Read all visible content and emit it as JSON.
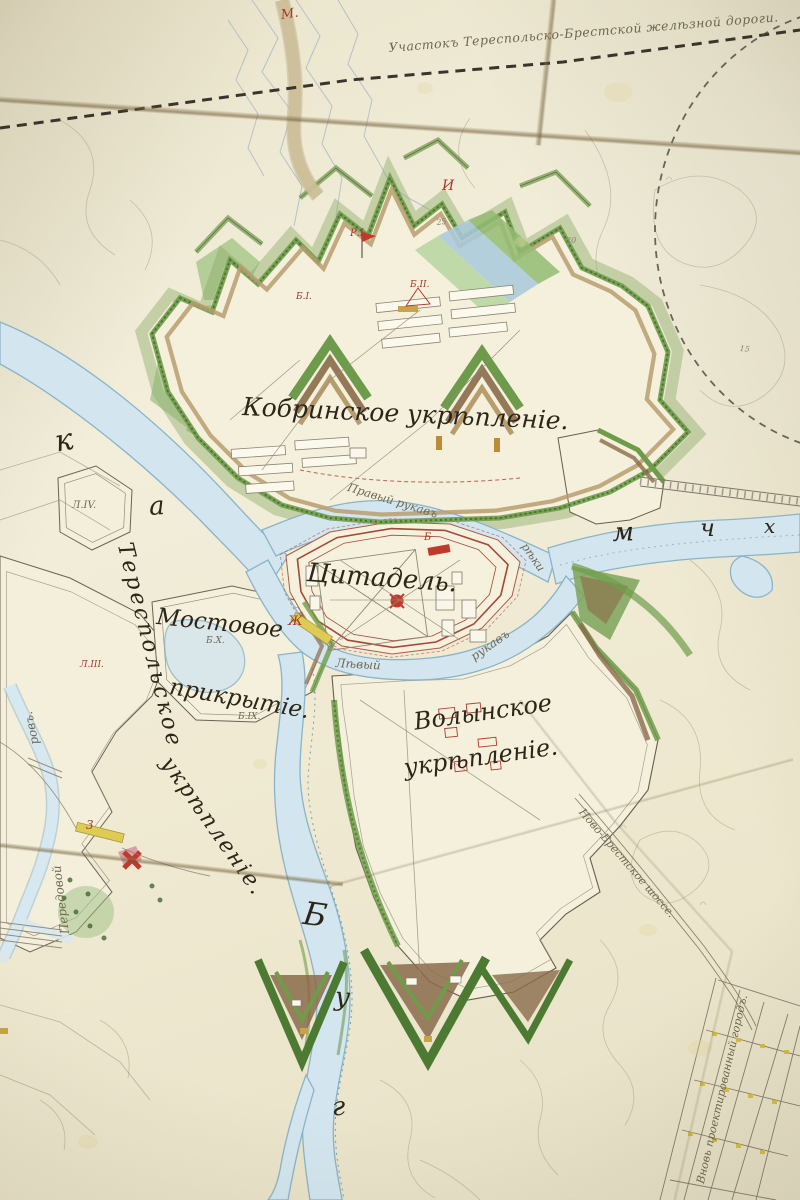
{
  "labels": {
    "railway_note": "Участокъ Тереспольско-Брестской желѣзной дороги.",
    "kobrin": "Кобринское укрѣпленіе.",
    "citadel": "Цитадель.",
    "volyn_line1": "Волынское",
    "volyn_line2": "укрѣпленіе.",
    "terespol_line1": "Тереспольское",
    "terespol_line2": "укрѣпленіе.",
    "mostovoe_line1": "Мостовое",
    "mostovoe_line2": "прикрытіе.",
    "pravy_rukav": "Правый рукавъ",
    "pravy_rukav_reki": "рѣки",
    "levy_rukav_1": "Лѣвый",
    "levy_rukav_2": "рукавъ",
    "peredovoy_1": "Передовой",
    "peredovoy_2": "ровъ.",
    "novo_brest_road": "Ново-Брестское шоссе.",
    "new_town": "Вновь проектированный городъ."
  },
  "river_letters": {
    "k": "к",
    "a": "а",
    "m": "м",
    "ch": "ч",
    "kh": "х",
    "b": "Б",
    "u": "у",
    "g": "г"
  },
  "red_marks": {
    "m_dot": "М.",
    "i": "И",
    "r1": "Р.I.",
    "b1": "Б.I.",
    "b2": "Б.II.",
    "zh": "Ж",
    "three": "3",
    "b_bridge": "Б",
    "l3": "Л.III."
  },
  "engineer_marks": {
    "l4": "Л.IV.",
    "b9": "Б.IX.",
    "b10": "Б.X."
  },
  "contour_numbers": {
    "n25": "25",
    "n20": "20",
    "n15": "15"
  },
  "colors": {
    "water": "#d3e6ef",
    "rampart_green": "#6f9c4a",
    "glacis_brown": "#8a6b4a",
    "ink_red": "#a8372b",
    "paper": "#efe9d1"
  }
}
